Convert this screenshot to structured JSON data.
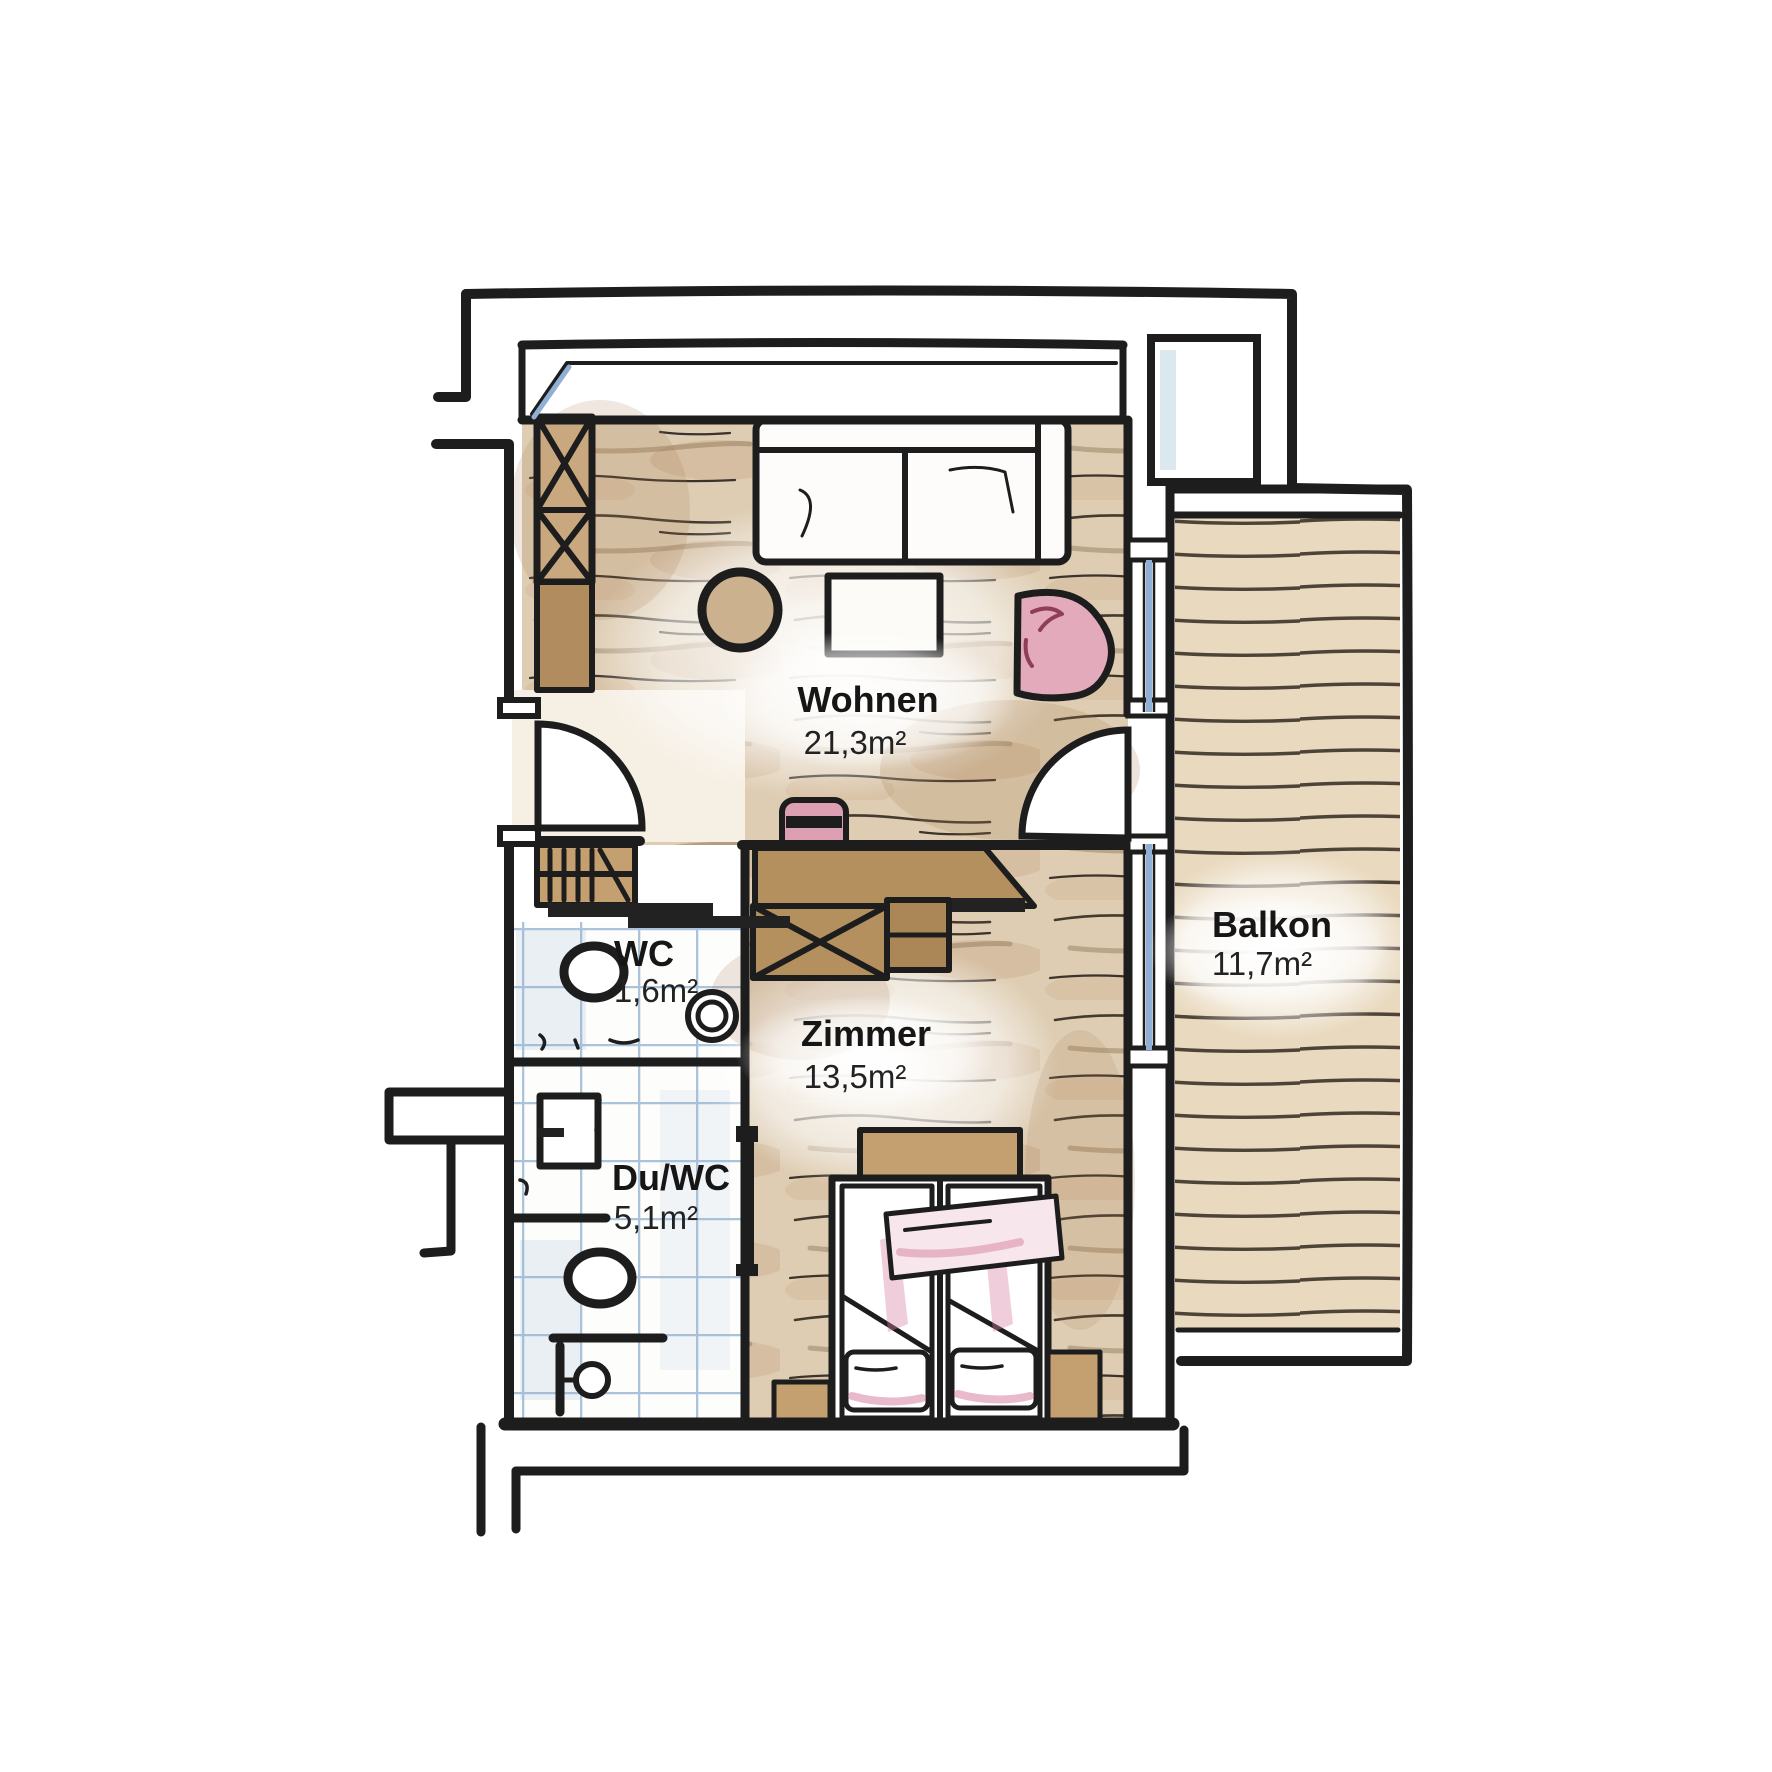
{
  "plan": {
    "type": "floor-plan",
    "style": "hand-drawn watercolor architectural sketch",
    "rooms": [
      {
        "name": "Wohnen",
        "area": "21,3m²"
      },
      {
        "name": "Balkon",
        "area": "11,7m²"
      },
      {
        "name": "WC",
        "area": "1,6m²"
      },
      {
        "name": "Zimmer",
        "area": "13,5m²"
      },
      {
        "name": "Du/WC",
        "area": "5,1m²"
      }
    ],
    "furniture": [
      "wardrobe-x",
      "sofa",
      "coffee-table",
      "pouf",
      "armchair",
      "coat-rack",
      "desk",
      "desk-chair",
      "sideboard-x",
      "double-bed",
      "pillows",
      "bedside-bench",
      "toilet",
      "washbasin",
      "shower",
      "floor-drain",
      "entry-door-swing",
      "balcony-door-swing",
      "sliding-door",
      "windows"
    ],
    "colors": {
      "wall": "#1d1d1d",
      "wood": "#dccaaf",
      "woodShade": "#c3a988",
      "balconyDeck": "#e9d9be",
      "tileLine": "#aac3da",
      "glass": "#8fb0d4",
      "pink": "#dd9fb2",
      "pinkSoft": "#f7e6eb",
      "furnitureBrown": "#b4905f",
      "furnitureBrownLight": "#c49f70",
      "paper": "#ffffff"
    }
  }
}
